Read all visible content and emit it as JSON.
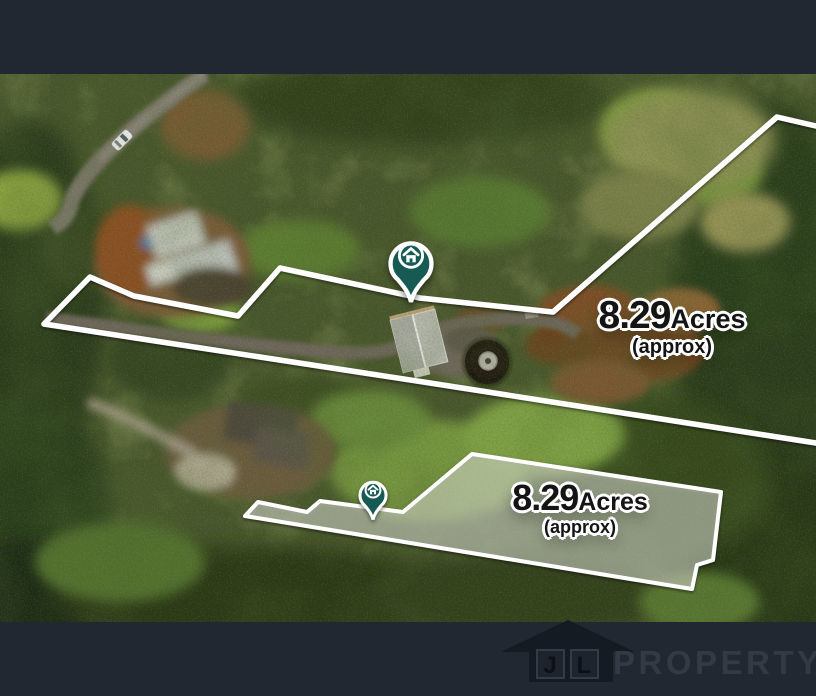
{
  "image_type": "aerial-property-boundary-photo",
  "letterbox": {
    "color": "#222831"
  },
  "parcels": {
    "upper": {
      "area": "8.29",
      "unit": "Acres",
      "qualifier": "(approx)"
    },
    "lower": {
      "area": "8.29",
      "unit": "Acres",
      "qualifier": "(approx)"
    }
  },
  "markers": {
    "upper_pin": {
      "icon": "house",
      "color": "#155a52"
    },
    "lower_pin": {
      "icon": "house",
      "color": "#155a52"
    }
  },
  "boundary_color": "#ffffff",
  "branding": {
    "initials": [
      "J",
      "L"
    ],
    "name": "PROPERTY"
  }
}
